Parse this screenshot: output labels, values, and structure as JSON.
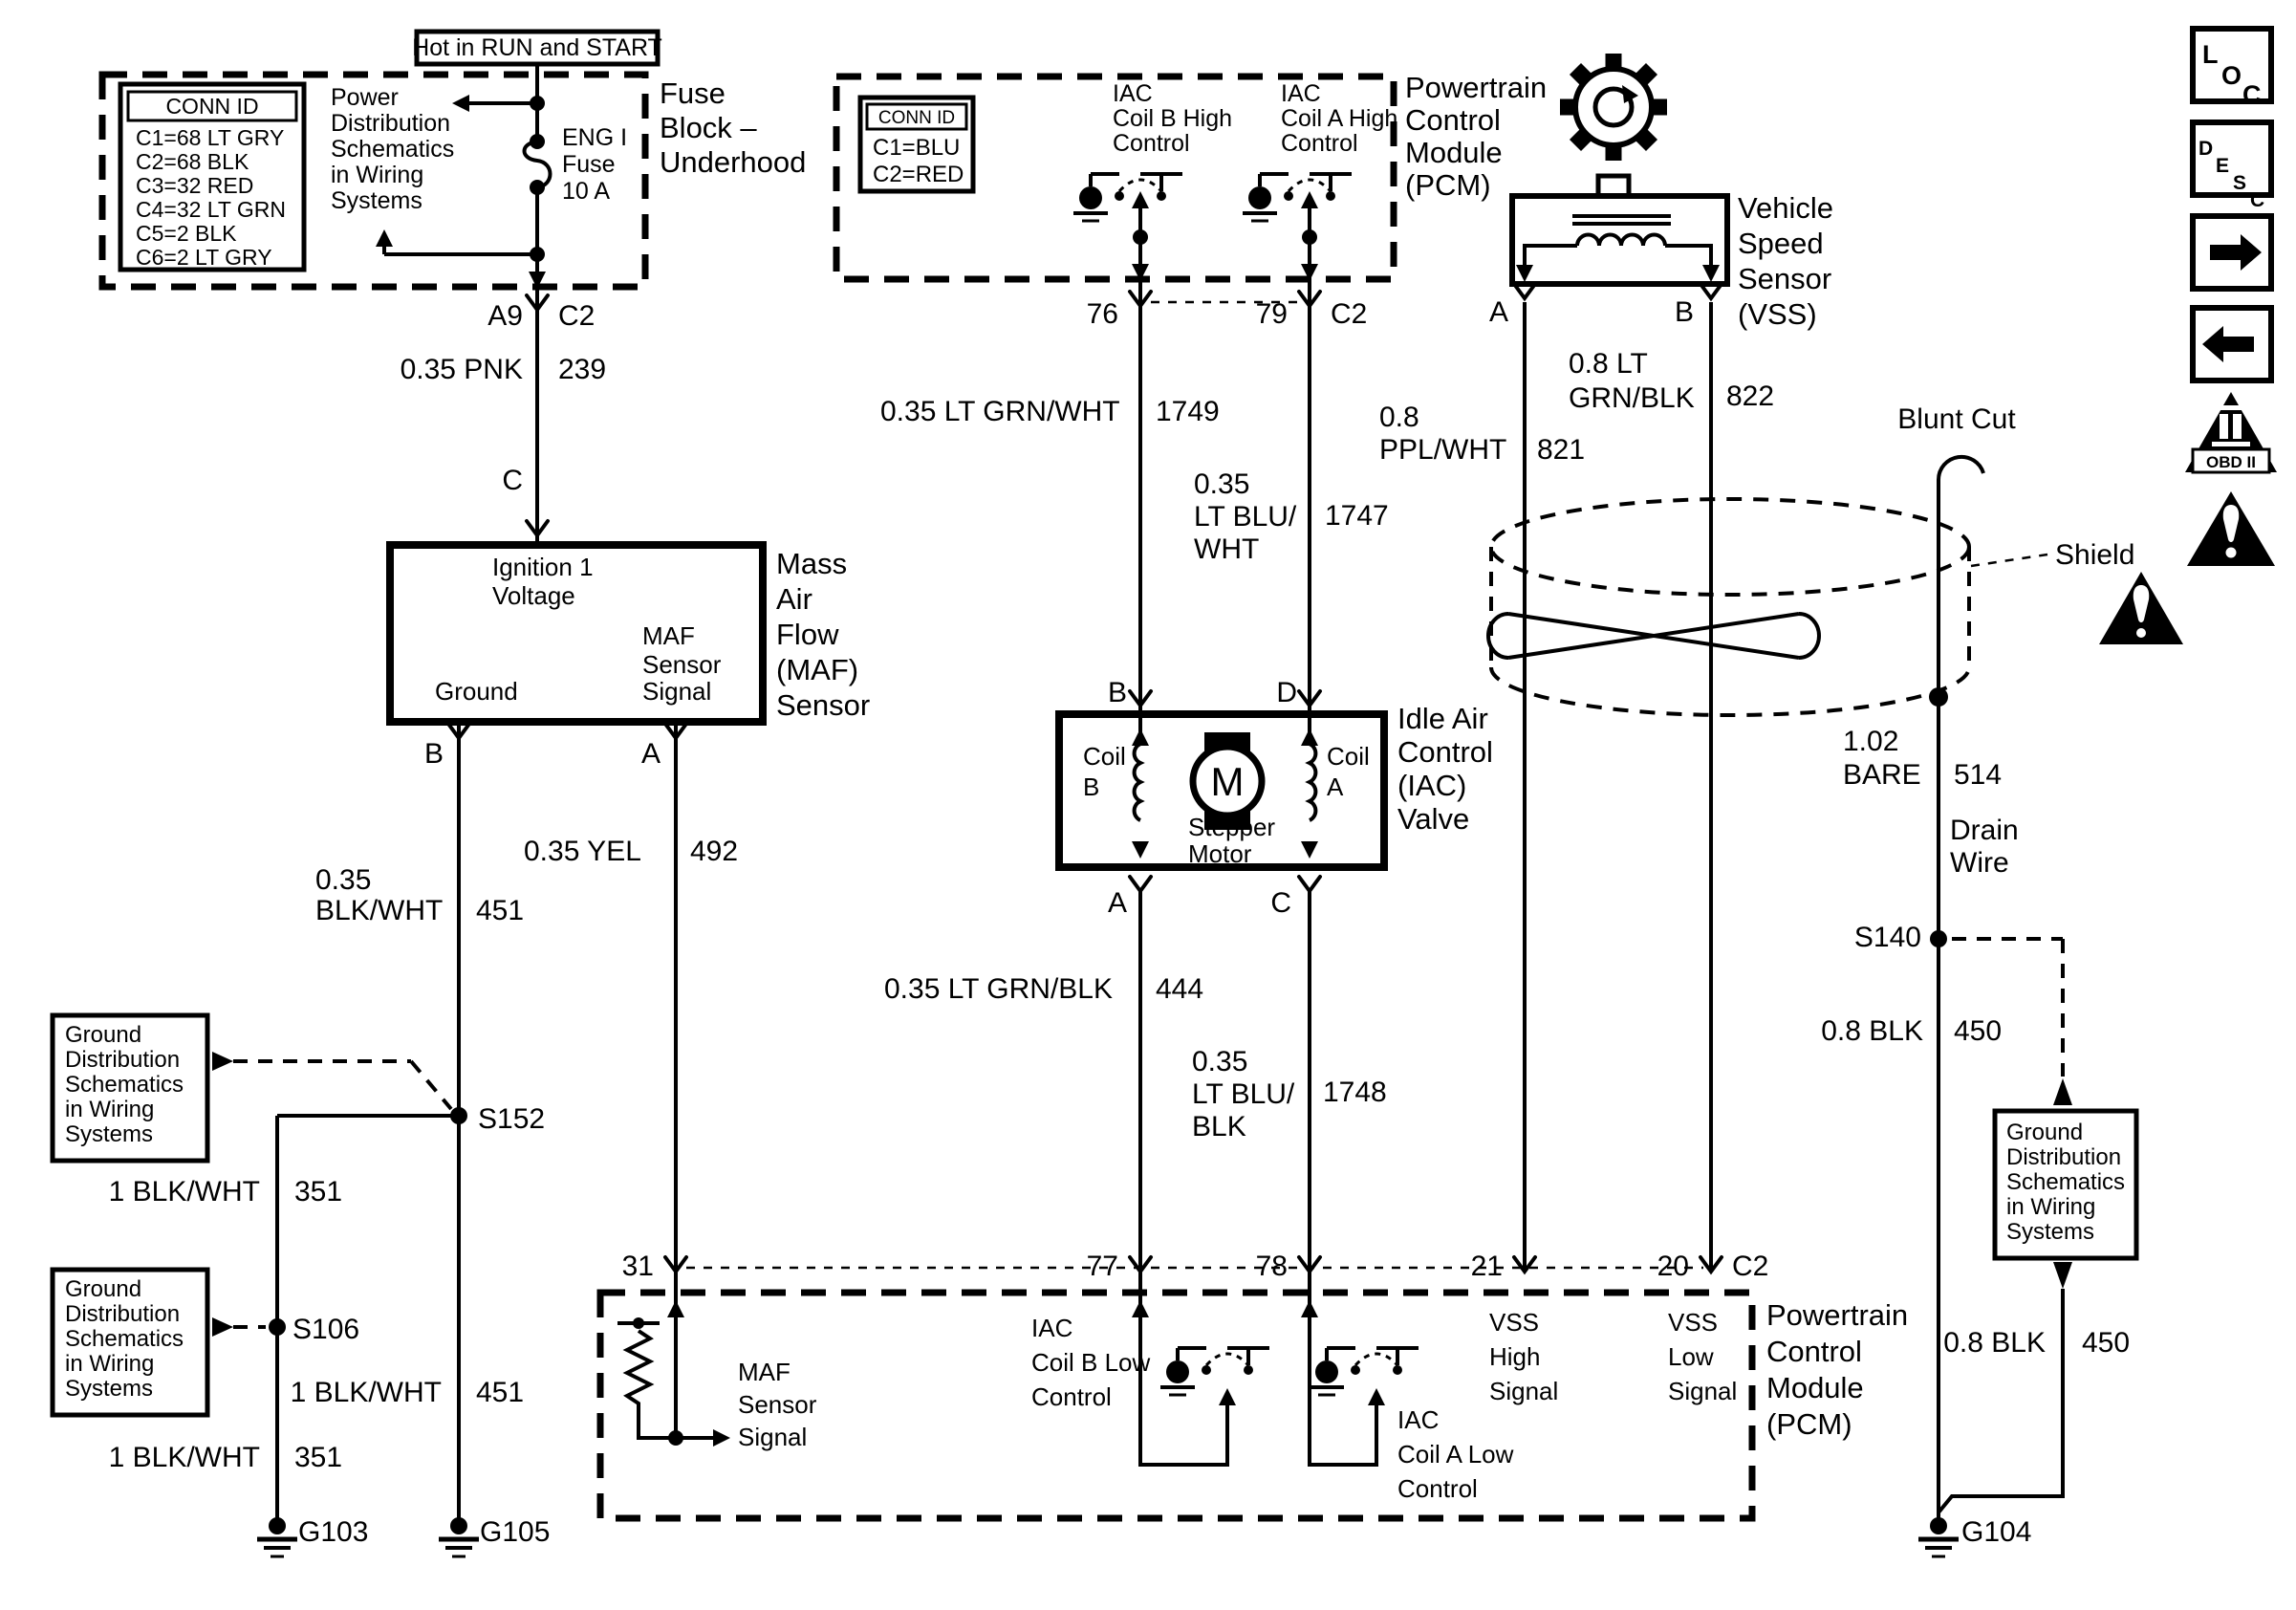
{
  "colors": {
    "background": "#ffffff",
    "ink": "#000000"
  },
  "hot_label": "Hot in RUN and START",
  "fuse_block": {
    "title_lines": [
      "Fuse",
      "Block –",
      "Underhood"
    ],
    "conn_id": {
      "title": "CONN ID",
      "rows": [
        "C1=68 LT GRY",
        "C2=68 BLK",
        "C3=32 RED",
        "C4=32 LT GRN",
        "C5=2 BLK",
        "C6=2 LT GRY"
      ]
    },
    "ref_lines": [
      "Power",
      "Distribution",
      "Schematics",
      "in Wiring",
      "Systems"
    ],
    "fuse_lines": [
      "ENG I",
      "Fuse",
      "10 A"
    ],
    "pin_left": "A9",
    "pin_right": "C2"
  },
  "maf_sensor": {
    "pin_top": "C",
    "pin_left": "B",
    "pin_right": "A",
    "ignition_lines": [
      "Ignition 1",
      "Voltage"
    ],
    "ground_label": "Ground",
    "signal_lines": [
      "MAF",
      "Sensor",
      "Signal"
    ],
    "title_lines": [
      "Mass",
      "Air",
      "Flow",
      "(MAF)",
      "Sensor"
    ]
  },
  "pcm_top": {
    "conn_id": {
      "title": "CONN ID",
      "rows": [
        "C1=BLU",
        "C2=RED"
      ]
    },
    "coil_b_lines": [
      "IAC",
      "Coil B High",
      "Control"
    ],
    "coil_a_lines": [
      "IAC",
      "Coil A High",
      "Control"
    ],
    "title_lines": [
      "Powertrain",
      "Control",
      "Module",
      "(PCM)"
    ],
    "pin_76": "76",
    "pin_79": "79",
    "conn": "C2"
  },
  "vss": {
    "title_lines": [
      "Vehicle",
      "Speed",
      "Sensor",
      "(VSS)"
    ],
    "pin_a": "A",
    "pin_b": "B"
  },
  "iac_valve": {
    "title_lines": [
      "Idle Air",
      "Control",
      "(IAC)",
      "Valve"
    ],
    "pin_b": "B",
    "pin_d": "D",
    "pin_a": "A",
    "pin_c": "C",
    "coil_b_lines": [
      "Coil",
      "B"
    ],
    "coil_a_lines": [
      "Coil",
      "A"
    ],
    "motor_letter": "M",
    "motor_lines": [
      "Stepper",
      "Motor"
    ]
  },
  "pcm_bottom": {
    "pin_31": "31",
    "pin_77": "77",
    "pin_78": "78",
    "pin_21": "21",
    "pin_20": "20",
    "conn": "C2",
    "maf_signal_lines": [
      "MAF",
      "Sensor",
      "Signal"
    ],
    "iac_b_lines": [
      "IAC",
      "Coil B Low",
      "Control"
    ],
    "iac_a_lines": [
      "IAC",
      "Coil A Low",
      "Control"
    ],
    "vss_high_lines": [
      "VSS",
      "High",
      "Signal"
    ],
    "vss_low_lines": [
      "VSS",
      "Low",
      "Signal"
    ],
    "title_lines": [
      "Powertrain",
      "Control",
      "Module",
      "(PCM)"
    ]
  },
  "wire_labels": {
    "pnk239": {
      "spec": "0.35 PNK",
      "num": "239"
    },
    "blkwht451": {
      "spec1": "0.35",
      "spec2": "BLK/WHT",
      "num": "451"
    },
    "yel492": {
      "spec": "0.35 YEL",
      "num": "492"
    },
    "ltgrnwht1749": {
      "spec": "0.35 LT GRN/WHT",
      "num": "1749"
    },
    "ltbluwht1747": {
      "spec1": "0.35",
      "spec2": "LT BLU/",
      "spec3": "WHT",
      "num": "1747"
    },
    "pplwht821": {
      "spec1": "0.8",
      "spec2": "PPL/WHT",
      "num": "821"
    },
    "ltgrnblk822": {
      "spec1": "0.8 LT",
      "spec2": "GRN/BLK",
      "num": "822"
    },
    "ltgrnblk444": {
      "spec": "0.35 LT GRN/BLK",
      "num": "444"
    },
    "ltblublk1748": {
      "spec1": "0.35",
      "spec2": "LT BLU/",
      "spec3": "BLK",
      "num": "1748"
    },
    "bare514": {
      "spec1": "1.02",
      "spec2": "BARE",
      "num": "514"
    },
    "blk450_drain": {
      "spec": "0.8 BLK",
      "num": "450"
    },
    "blk450_ground": {
      "spec": "0.8 BLK",
      "num": "450"
    },
    "blkwht351_upper": {
      "spec": "1 BLK/WHT",
      "num": "351"
    },
    "blkwht451_lower": {
      "spec": "1 BLK/WHT",
      "num": "451"
    },
    "blkwht351_lower": {
      "spec": "1 BLK/WHT",
      "num": "351"
    }
  },
  "ground_ref_lines": [
    "Ground",
    "Distribution",
    "Schematics",
    "in Wiring",
    "Systems"
  ],
  "splices": {
    "s152": "S152",
    "s106": "S106",
    "s140": "S140"
  },
  "grounds": {
    "g103": "G103",
    "g105": "G105",
    "g104": "G104"
  },
  "misc": {
    "blunt_cut": "Blunt Cut",
    "shield": "Shield",
    "drain_lines": [
      "Drain",
      "Wire"
    ]
  },
  "side_toolbar": {
    "loc_letters": [
      "L",
      "O",
      "C"
    ],
    "desc_letters": [
      "D",
      "E",
      "S",
      "C"
    ],
    "obd_label": "OBD II"
  }
}
